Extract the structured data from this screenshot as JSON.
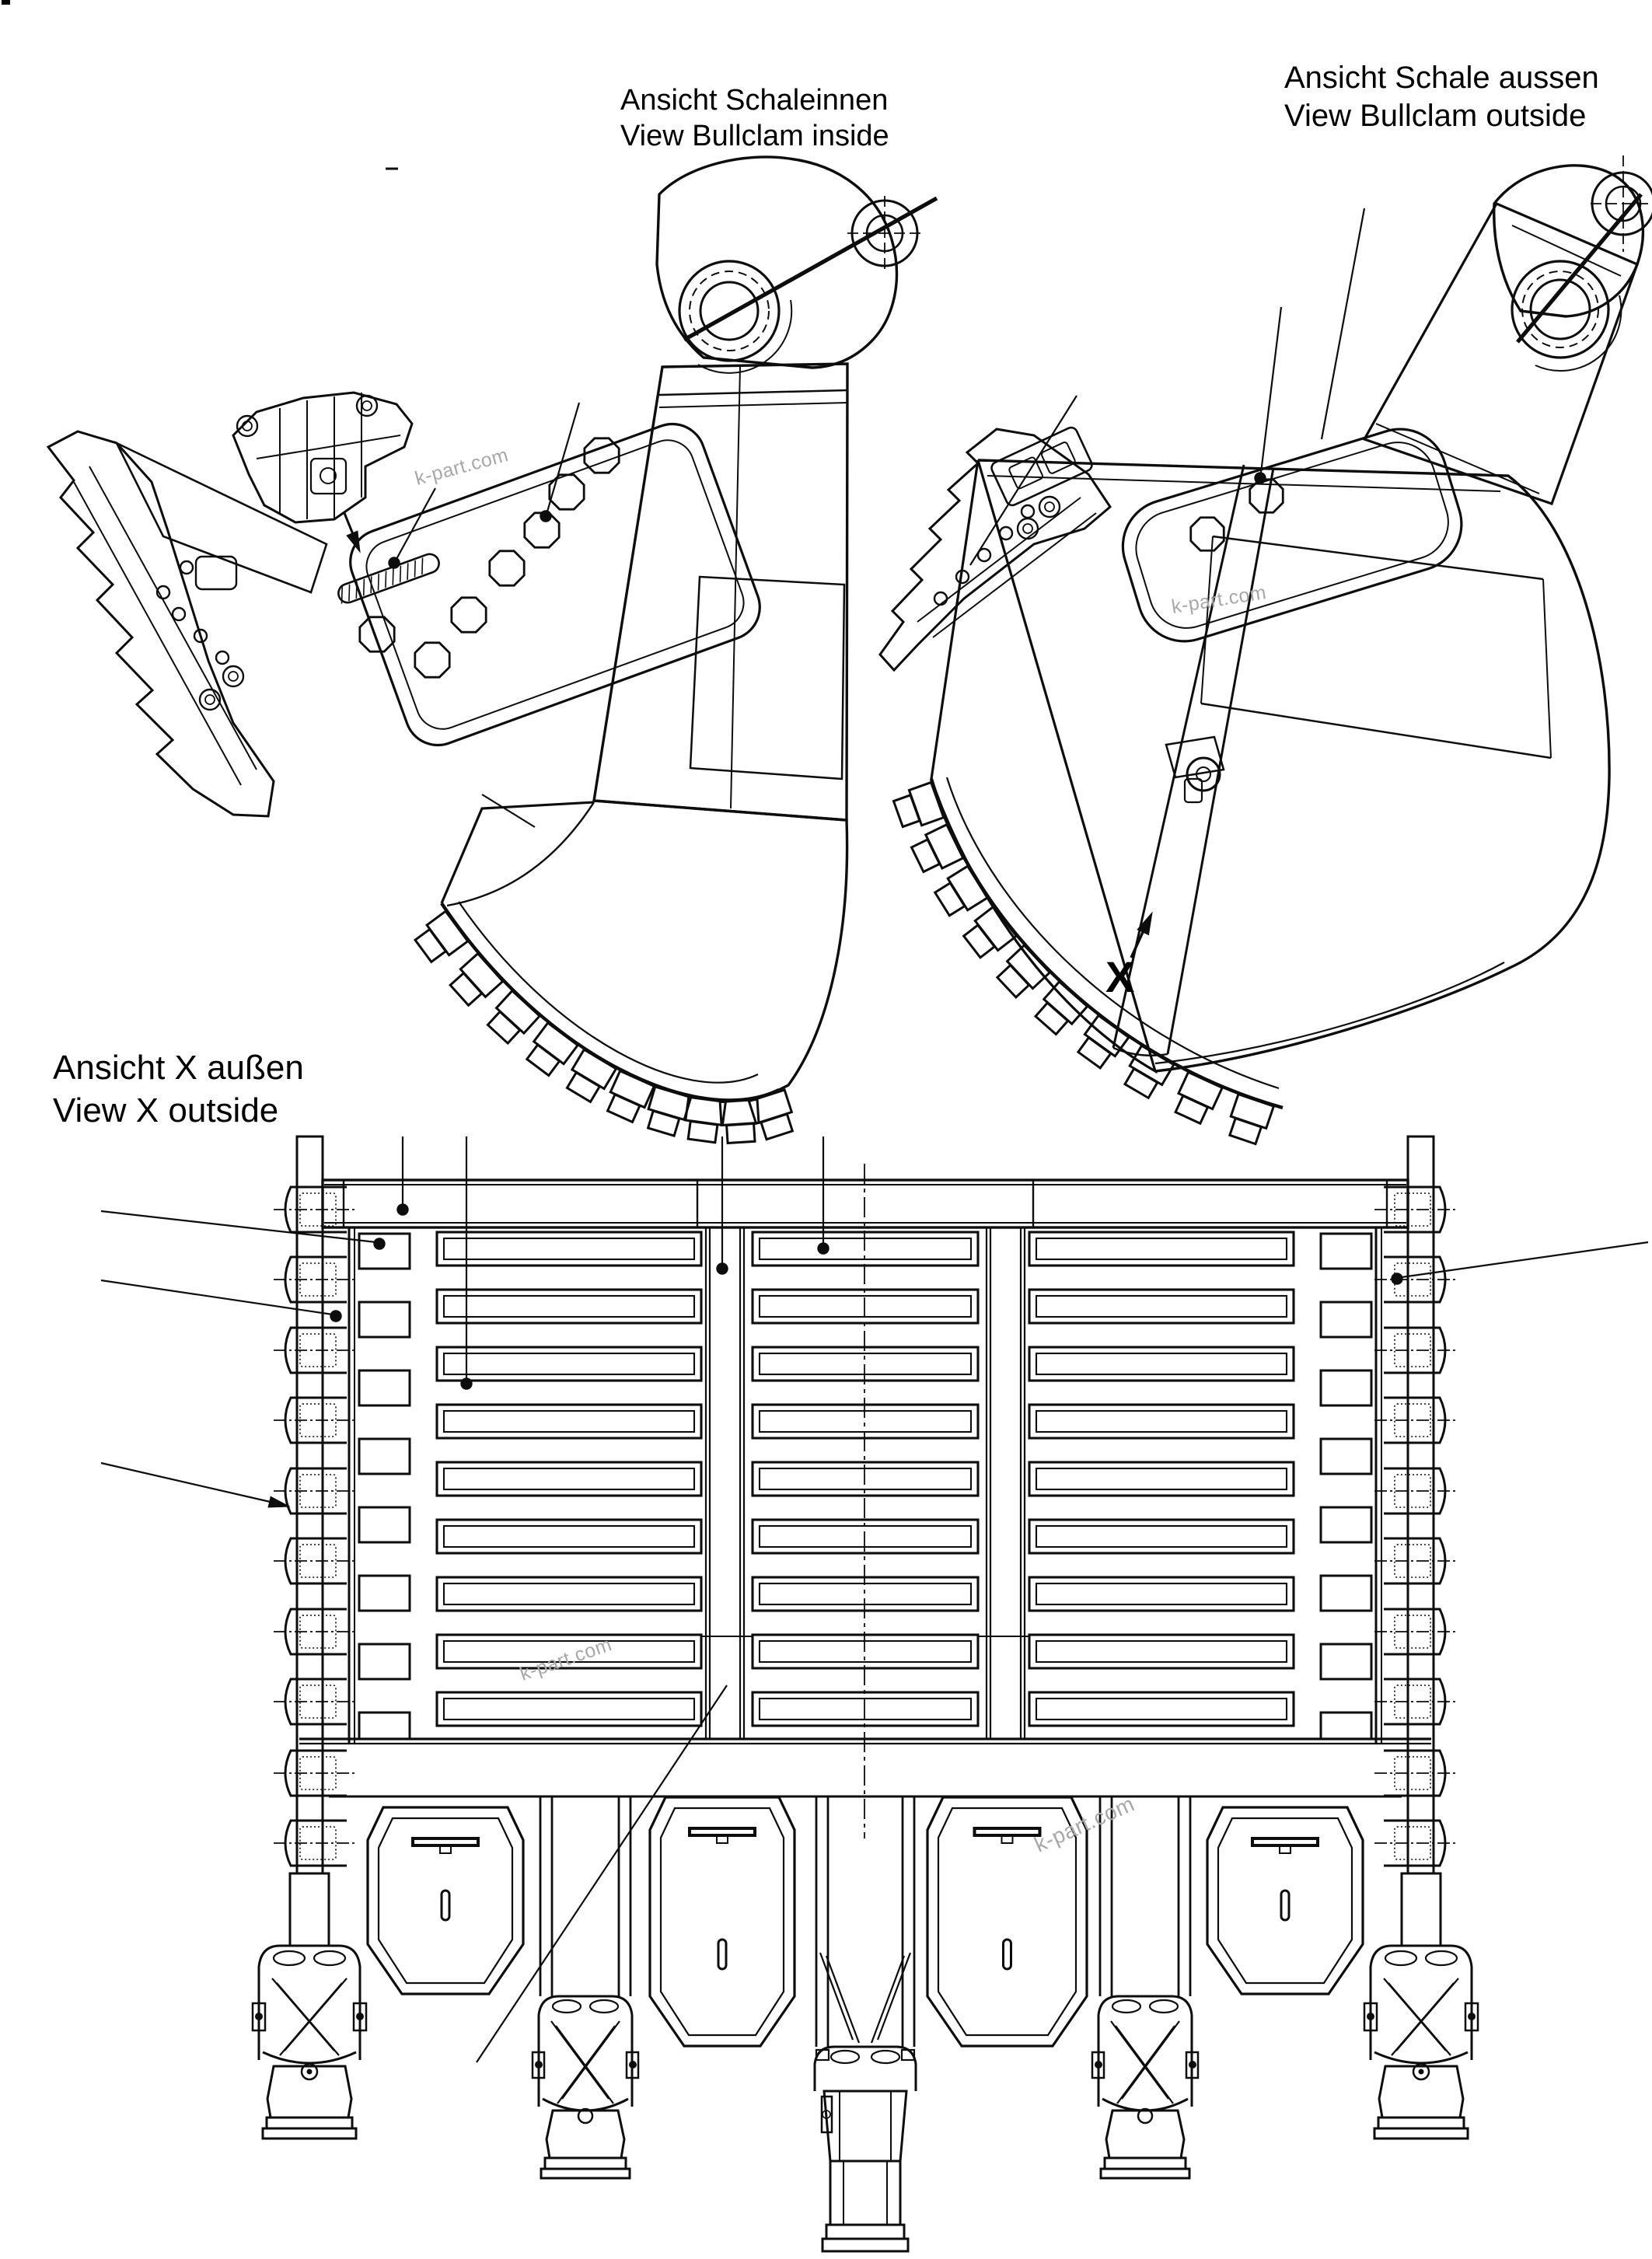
{
  "titles": {
    "inside": {
      "line1": "Ansicht Schaleinnen",
      "line2": "View Bullclam inside"
    },
    "outside": {
      "line1": "Ansicht Schale aussen",
      "line2": "View Bullclam outside"
    },
    "view_x": {
      "line1": "Ansicht X außen",
      "line2": "View X outside"
    }
  },
  "view_marker": {
    "label": "X"
  },
  "watermark": {
    "text": "k-part.com",
    "color": "#a8a8a8"
  },
  "drawing": {
    "stroke_color": "#0d0d0d",
    "view_x": {
      "bar_rows": 9,
      "bar_columns": 3,
      "side_squares_per_side": 8,
      "side_wear_blocks_per_side": 10,
      "lip_shrouds": 4,
      "teeth_assemblies": 5,
      "top_leader_lines": 4,
      "diagonal_leader_lines": 5
    },
    "view_inside": {
      "edge_teeth": 10
    },
    "view_outside": {
      "edge_teeth": 10
    }
  }
}
